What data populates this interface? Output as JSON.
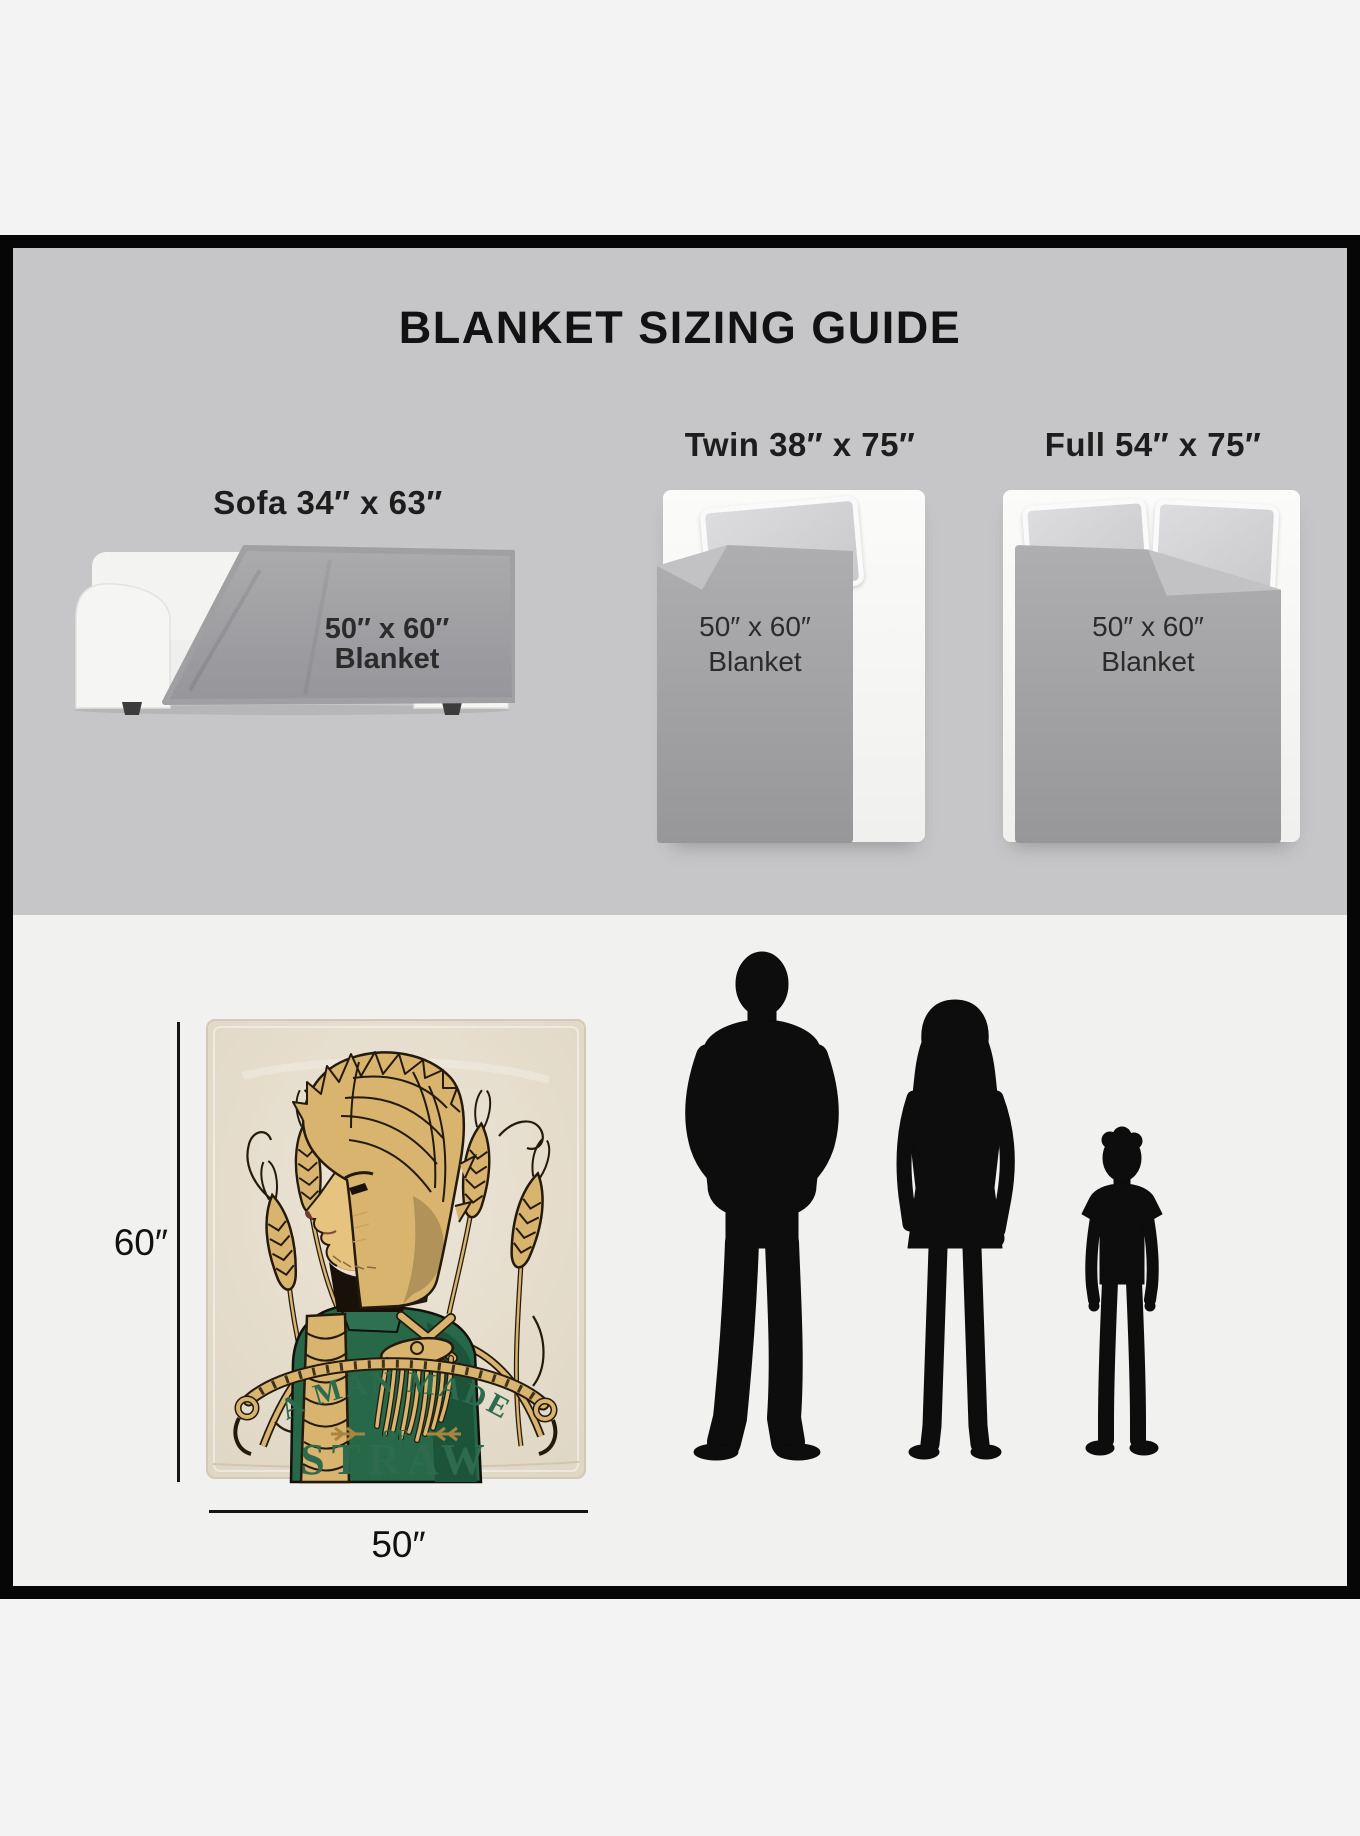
{
  "page": {
    "outer_background": "#f3f3f3",
    "frame_color": "#060606"
  },
  "guide": {
    "title": "BLANKET SIZING GUIDE",
    "panel_background": "#c6c6c8",
    "overlay": {
      "line1": "50″ x 60″",
      "line2": "Blanket"
    },
    "scenes": [
      {
        "id": "sofa",
        "label": "Sofa 34″ x 63″",
        "illustration": "sofa-with-draped-blanket"
      },
      {
        "id": "twin",
        "label": "Twin 38″ x 75″",
        "illustration": "twin-bed-with-blanket"
      },
      {
        "id": "full",
        "label": "Full 54″ x 75″",
        "illustration": "full-bed-with-blanket"
      }
    ]
  },
  "product": {
    "panel_background": "#f1f1f0",
    "height_label": "60″",
    "width_label": "50″",
    "blanket_color": "#e7dfd0",
    "artwork": {
      "arc_text": "A MAN MADE",
      "of_text": "OF",
      "main_text": "STRAW",
      "text_color": "#2e6b4e",
      "straw_color": "#d9b46f",
      "coat_color": "#266848",
      "illustration": "scarecrow-man-portrait-with-wheat"
    },
    "scale_figures": [
      {
        "name": "adult-man-silhouette"
      },
      {
        "name": "adult-woman-silhouette"
      },
      {
        "name": "child-silhouette"
      }
    ]
  }
}
